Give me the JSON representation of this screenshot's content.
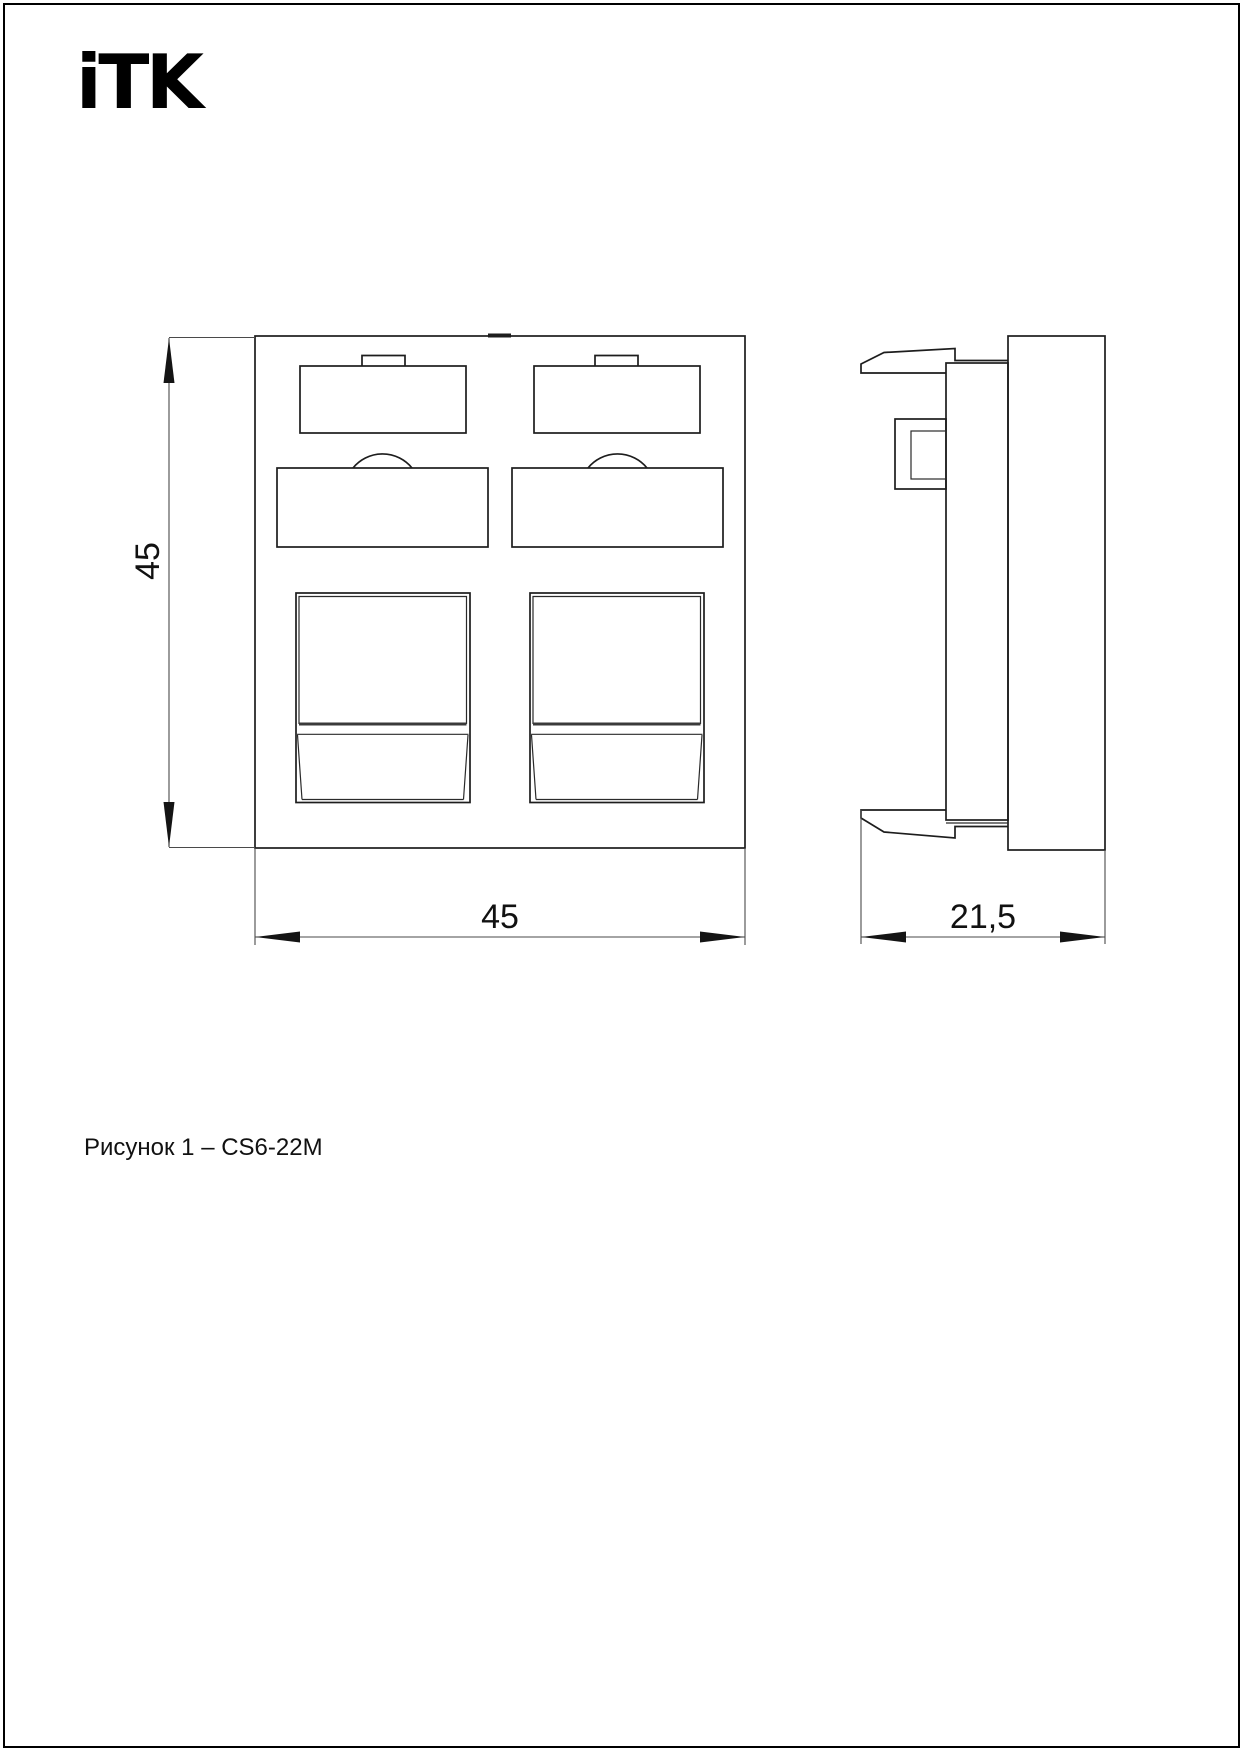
{
  "brand": {
    "logo": "iTK"
  },
  "views": {
    "front": {
      "height_label": "45",
      "width_label": "45"
    },
    "side": {
      "depth_label": "21,5"
    }
  },
  "caption": "Рисунок 1 – CS6-22M"
}
